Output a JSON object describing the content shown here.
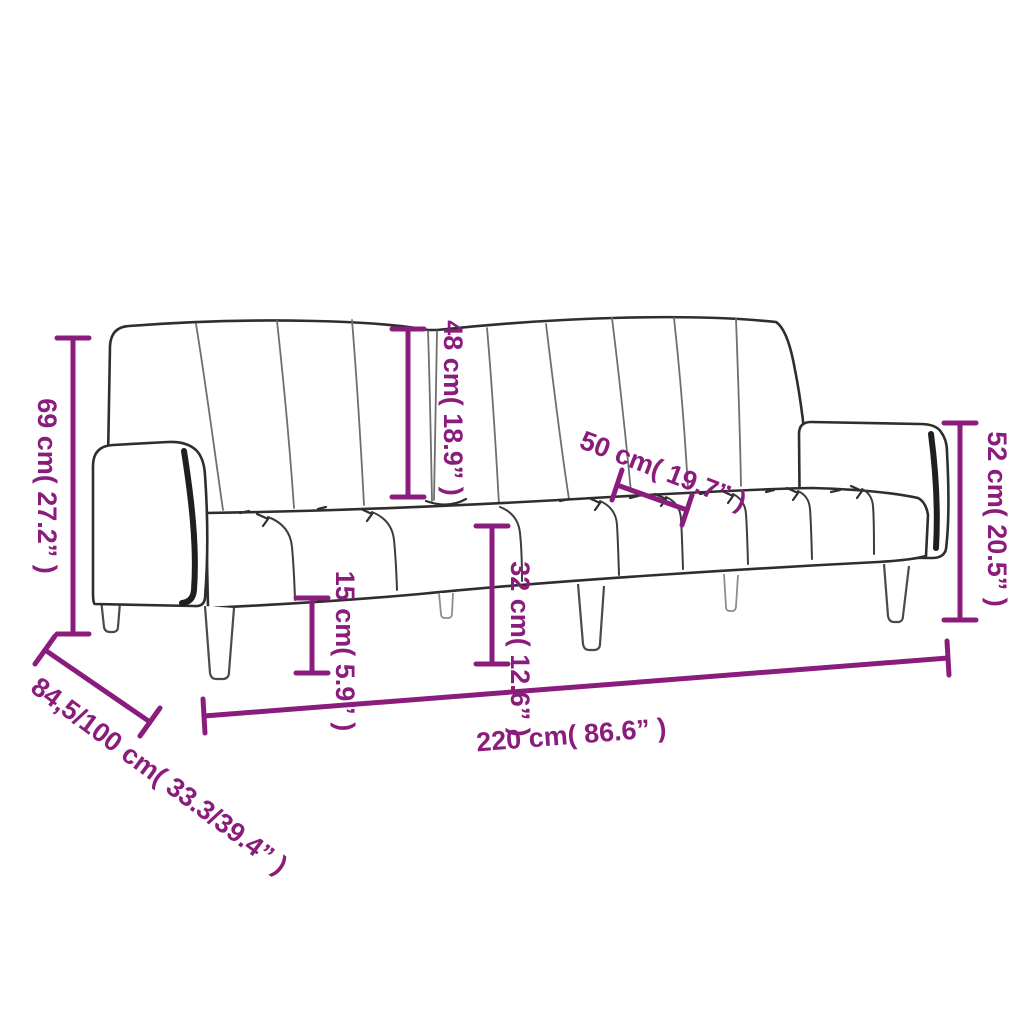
{
  "diagram": {
    "type": "product-dimension-line-drawing",
    "subject": "sofa-bed",
    "colors": {
      "accent": "#8a1c7c",
      "line": "#2e2e2e",
      "background": "#ffffff"
    },
    "dimensions": {
      "total_height": {
        "label": "69 cm( 27.2” )"
      },
      "backrest_height": {
        "label": "48 cm( 18.9” )"
      },
      "seat_depth": {
        "label": "50 cm( 19.7” )"
      },
      "right_height": {
        "label": "52 cm( 20.5” )"
      },
      "leg_height": {
        "label": "15 cm( 5.9” )"
      },
      "seat_height": {
        "label": "32 cm( 12.6” )"
      },
      "total_width": {
        "label": "220 cm( 86.6” )"
      },
      "total_depth": {
        "label": "84,5/100 cm( 33.3/39.4” )"
      }
    }
  }
}
